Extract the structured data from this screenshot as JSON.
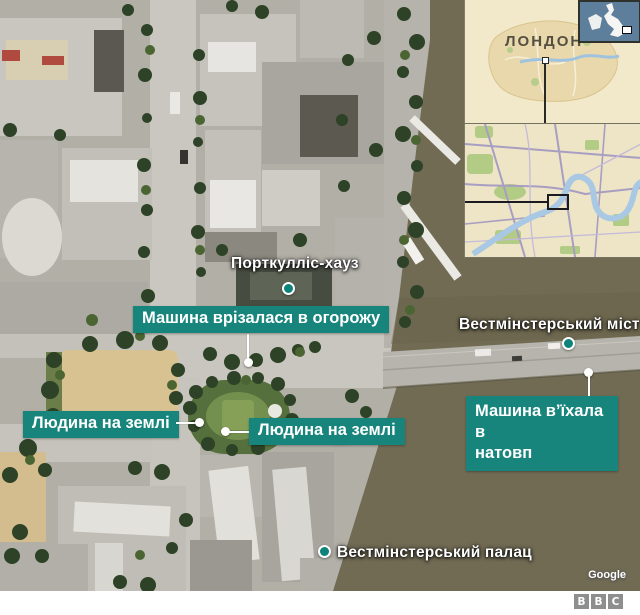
{
  "map": {
    "place_labels": {
      "portcullis": "Порткулліс-хауз",
      "bridge": "Вестмінстерський міст",
      "palace": "Вестмінстерський палац"
    },
    "callouts": {
      "crash_fence": "Машина врізалася в огорожу",
      "person_left": "Людина на землі",
      "person_right": "Людина на землі",
      "crowd_line1": "Машина в’їхала в",
      "crowd_line2": "натовп"
    },
    "attribution": "Google"
  },
  "insets": {
    "london_label": "ЛОНДОН"
  },
  "footer": {
    "bbc": [
      "B",
      "B",
      "C"
    ]
  },
  "colors": {
    "callout_teal": "#17857b",
    "marker_teal": "#0d837a",
    "river_water": "#716b54",
    "uk_inset_sea": "#5d7f9b",
    "inset_land": "#f2e8ca"
  }
}
